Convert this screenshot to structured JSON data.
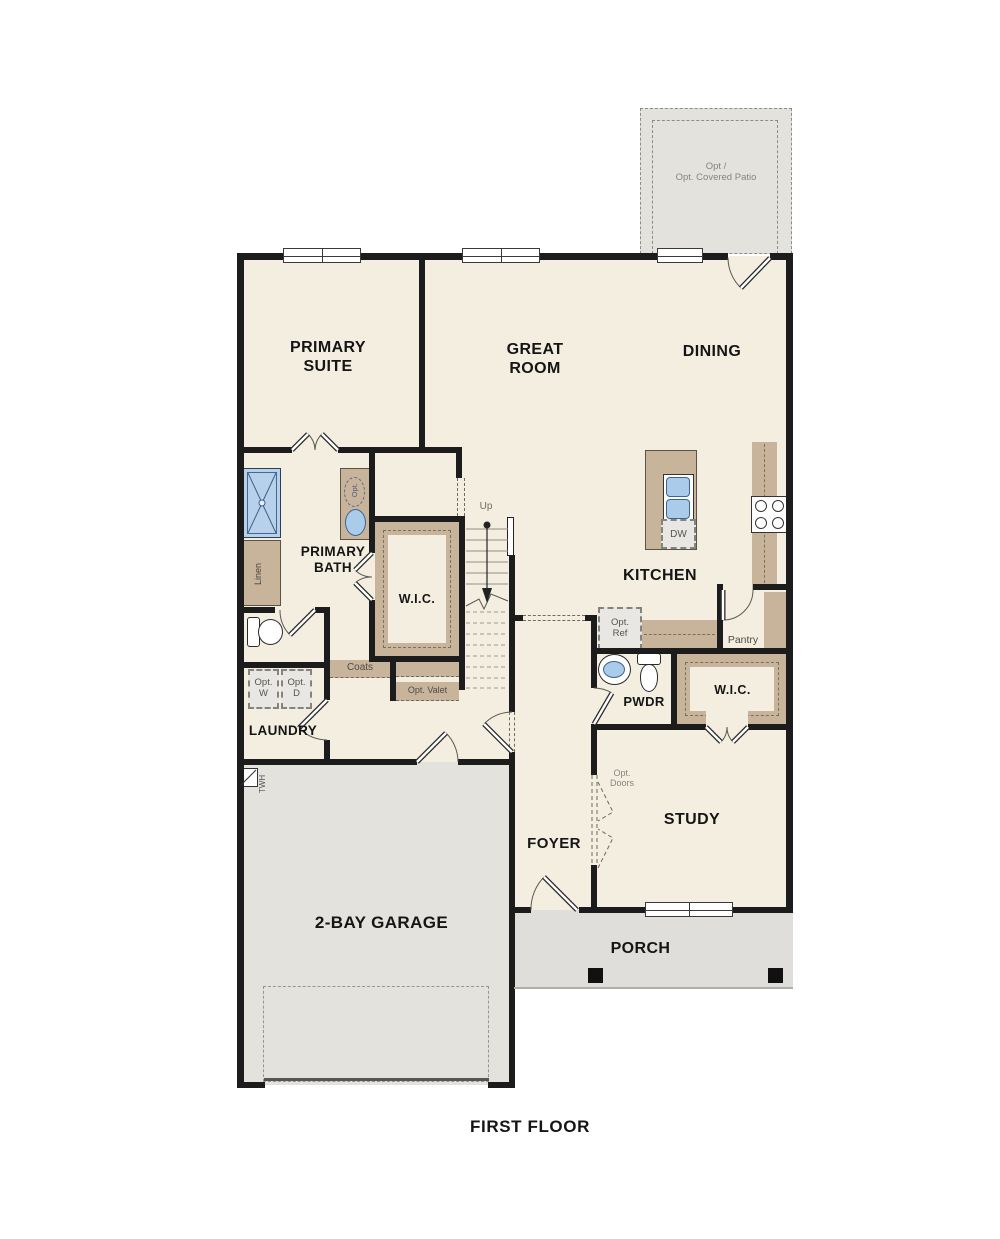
{
  "plan": {
    "title": "FIRST FLOOR",
    "rooms": {
      "patio": {
        "line1": "Opt /",
        "line2": "Opt. Covered Patio"
      },
      "primary_suite": {
        "line1": "PRIMARY",
        "line2": "SUITE"
      },
      "great_room": {
        "line1": "GREAT",
        "line2": "ROOM"
      },
      "dining": {
        "label": "DINING"
      },
      "kitchen": {
        "label": "KITCHEN"
      },
      "primary_bath": {
        "line1": "PRIMARY",
        "line2": "BATH"
      },
      "wic_primary": {
        "label": "W.I.C."
      },
      "laundry": {
        "label": "LAUNDRY"
      },
      "pwdr": {
        "label": "PWDR"
      },
      "wic_study": {
        "label": "W.I.C."
      },
      "foyer": {
        "label": "FOYER"
      },
      "study": {
        "label": "STUDY"
      },
      "porch": {
        "label": "PORCH"
      },
      "garage": {
        "label": "2-BAY GARAGE"
      }
    },
    "annotations": {
      "up": "Up",
      "linen": "Linen",
      "opt_vanity": "Opt.",
      "dw": "DW",
      "opt_ref": {
        "line1": "Opt.",
        "line2": "Ref"
      },
      "pantry": "Pantry",
      "coats": "Coats",
      "opt_valet": "Opt. Valet",
      "opt_washer": {
        "line1": "Opt.",
        "line2": "W"
      },
      "opt_dryer": {
        "line1": "Opt.",
        "line2": "D"
      },
      "twh": "TWH",
      "opt_doors": {
        "line1": "Opt.",
        "line2": "Doors"
      }
    },
    "colors": {
      "wall": "#1c1c1c",
      "floor": "#f3eee0",
      "concrete": "#e4e2dd",
      "casework": "#c8b49a",
      "fixture_blue": "#aacbe9"
    }
  }
}
